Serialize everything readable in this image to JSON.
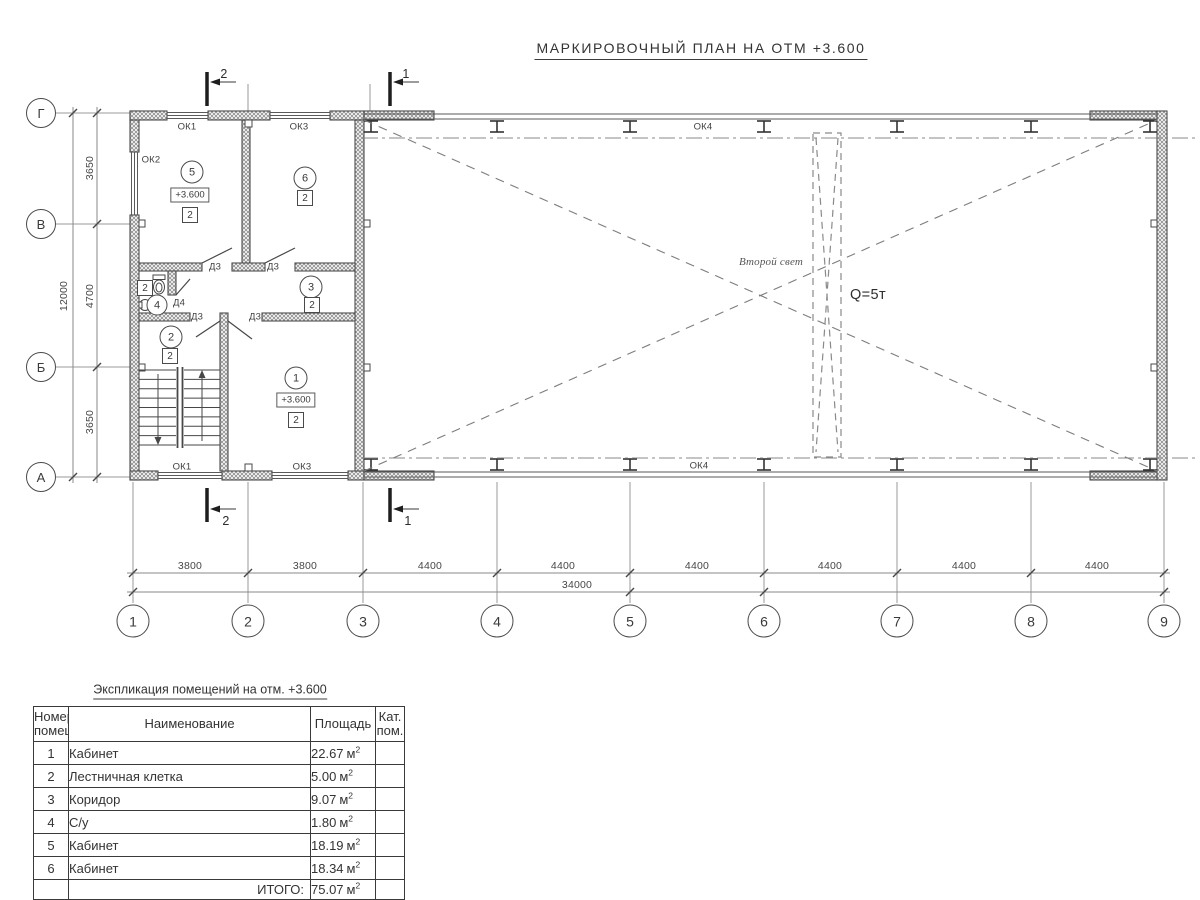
{
  "title": "МАРКИРОВОЧНЫЙ ПЛАН НА ОТМ +3.600",
  "axes": {
    "rows": [
      "Г",
      "В",
      "Б",
      "А"
    ],
    "cols": [
      "1",
      "2",
      "3",
      "4",
      "5",
      "6",
      "7",
      "8",
      "9"
    ]
  },
  "dims": {
    "v": [
      "3650",
      "4700",
      "3650"
    ],
    "v_total": "12000",
    "h": [
      "3800",
      "3800",
      "4400",
      "4400",
      "4400",
      "4400",
      "4400",
      "4400"
    ],
    "h_total": "34000"
  },
  "sections": {
    "one": "1",
    "two": "2"
  },
  "labels": {
    "ok1": "ОК1",
    "ok2": "ОК2",
    "ok3": "ОК3",
    "ok4": "ОК4",
    "d3": "Д3",
    "d4": "Д4",
    "second_light": "Второй свет",
    "crane": "Q=5т"
  },
  "rooms": {
    "r1": {
      "num": "1",
      "elev": "+3.600",
      "cat": "2"
    },
    "r2": {
      "num": "2",
      "cat": "2"
    },
    "r3": {
      "num": "3",
      "cat": "2"
    },
    "r4": {
      "num": "4",
      "cat": "2"
    },
    "r5": {
      "num": "5",
      "elev": "+3.600",
      "cat": "2"
    },
    "r6": {
      "num": "6",
      "cat": "2"
    }
  },
  "table": {
    "title": "Экспликация помещений на отм. +3.600",
    "headers": {
      "num_l1": "Номер",
      "num_l2": "помещ.",
      "name": "Наименование",
      "area": "Площадь",
      "cat_l1": "Кат.",
      "cat_l2": "пом."
    },
    "unit": "м",
    "sup": "2",
    "rows": [
      {
        "num": "1",
        "name": "Кабинет",
        "area": "22.67"
      },
      {
        "num": "2",
        "name": "Лестничная клетка",
        "area": "5.00"
      },
      {
        "num": "3",
        "name": "Коридор",
        "area": "9.07"
      },
      {
        "num": "4",
        "name": "С/у",
        "area": "1.80"
      },
      {
        "num": "5",
        "name": "Кабинет",
        "area": "18.19"
      },
      {
        "num": "6",
        "name": "Кабинет",
        "area": "18.34"
      }
    ],
    "total_label": "ИТОГО:",
    "total_area": "75.07"
  }
}
